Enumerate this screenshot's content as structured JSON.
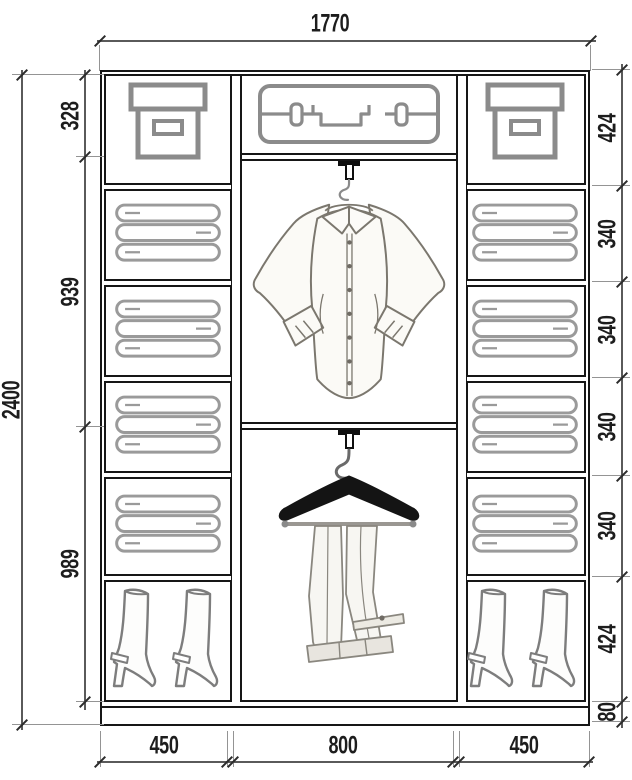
{
  "dimensions": {
    "overall_width": "1770",
    "overall_height": "2400",
    "middle_section_chain": [
      "328",
      "939",
      "989"
    ],
    "side_section_chain": [
      "424",
      "340",
      "340",
      "340",
      "340",
      "424",
      "80"
    ],
    "bottom_chain": [
      "450",
      "800",
      "450"
    ]
  },
  "icons": [
    "storage-box-icon",
    "suitcase-icon",
    "folded-clothes-icon",
    "boots-icon",
    "shirt-on-hanger-icon",
    "trousers-on-hanger-icon",
    "rail-hook-icon"
  ],
  "colors": {
    "structure_line": "#161616",
    "dimension_line": "#5a5a5a",
    "icon_stroke": "#8b8b8b",
    "text": "#1d1d1d",
    "hanger": "#141414",
    "background": "#ffffff"
  }
}
